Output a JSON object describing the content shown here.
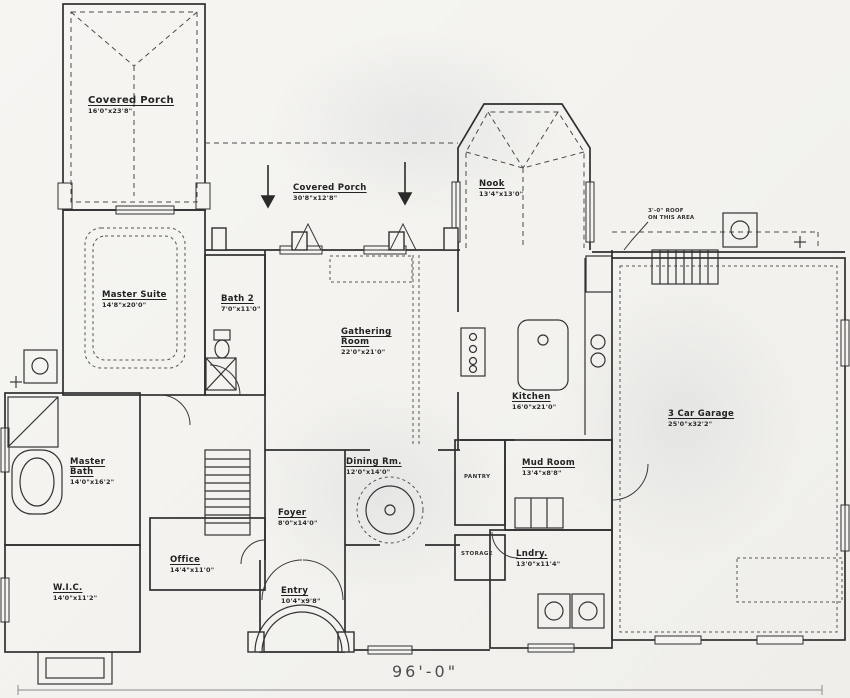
{
  "drawing": {
    "type": "residential-floor-plan",
    "ink_color": "#2f2f2f",
    "paper_color": "#f5f4f0",
    "overall_width_dim": "96'-0\""
  },
  "rooms": {
    "covered_porch_left": {
      "name": "Covered Porch",
      "dims": "16'0\"x23'8\""
    },
    "covered_porch_center": {
      "name": "Covered Porch",
      "dims": "30'8\"x12'8\""
    },
    "nook": {
      "name": "Nook",
      "dims": "13'4\"x13'0\""
    },
    "master_suite": {
      "name": "Master Suite",
      "dims": "14'8\"x20'0\""
    },
    "bath2": {
      "name": "Bath 2",
      "dims": "7'0\"x11'0\""
    },
    "gathering_room": {
      "name": "Gathering Room",
      "dims": "22'0\"x21'0\""
    },
    "kitchen": {
      "name": "Kitchen",
      "dims": "16'0\"x21'0\""
    },
    "garage": {
      "name": "3 Car Garage",
      "dims": "25'0\"x32'2\""
    },
    "master_bath": {
      "name": "Master Bath",
      "dims": "14'0\"x16'2\""
    },
    "wic": {
      "name": "W.I.C.",
      "dims": "14'0\"x11'2\""
    },
    "dining": {
      "name": "Dining Rm.",
      "dims": "12'0\"x14'0\""
    },
    "foyer": {
      "name": "Foyer",
      "dims": "8'0\"x14'0\""
    },
    "office": {
      "name": "Office",
      "dims": "14'4\"x11'0\""
    },
    "entry": {
      "name": "Entry",
      "dims": "10'4\"x9'8\""
    },
    "mud_room": {
      "name": "Mud Room",
      "dims": "13'4\"x8'8\""
    },
    "laundry": {
      "name": "Lndry.",
      "dims": "13'0\"x11'4\""
    },
    "pantry": {
      "name": "PANTRY"
    },
    "storage": {
      "name": "STORAGE"
    }
  },
  "notes": {
    "roof_line1": "3'-0\" ROOF",
    "roof_line2": "ON THIS AREA"
  }
}
